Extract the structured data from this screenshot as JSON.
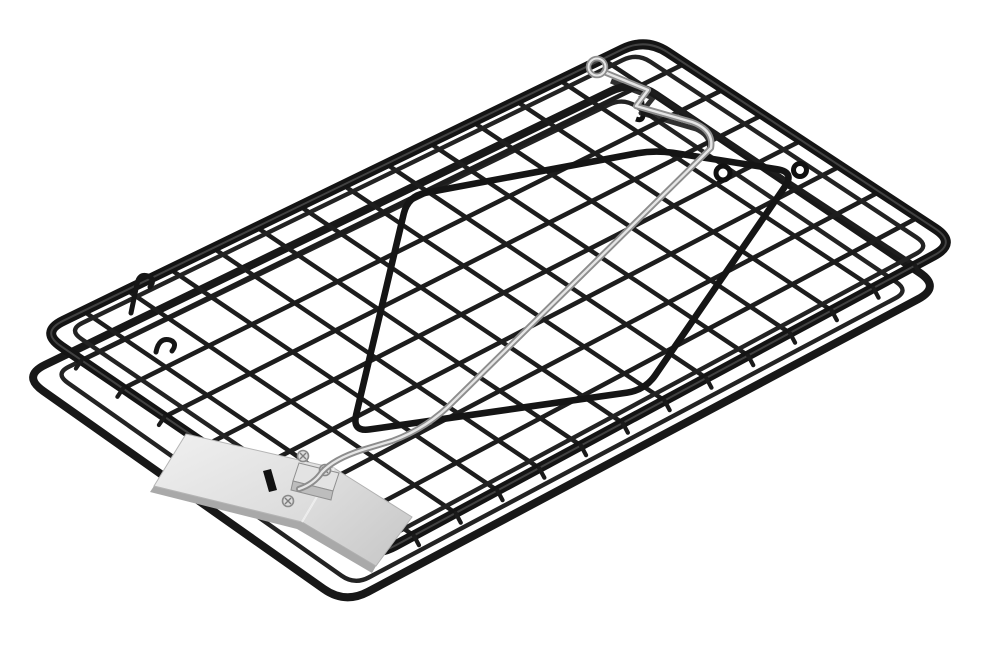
{
  "meta": {
    "alt": "Product photo of a flat black wire-mesh rodent tip trap shown at an angle on a plain white background, fitted with a stainless steel spring rod with an eyelet and zigzag crank, a black trigger bail wire, and a riveted stainless steel pedal plate with a latch bracket",
    "scene": "product-photo",
    "background": "#ffffff"
  },
  "palette": {
    "background": "#ffffff",
    "wire": "#1d1d1d",
    "wire_deep": "#141414",
    "wire_sheen": "#5a5a5a",
    "steel_dark": "#8d8d8d",
    "steel_light": "#e6e6e6",
    "plate_light": "#ebebeb",
    "plate_mid": "#d6d6d6",
    "plate_shadow": "#a9a9a9",
    "slot_black": "#111111"
  },
  "grid": {
    "columns": 14,
    "rows": 8
  },
  "object": {
    "name": "wire mesh tip trap",
    "parts": [
      {
        "id": "top-frame",
        "label": "black outer frame, top face, rounded corners"
      },
      {
        "id": "bottom-frame",
        "label": "black outer frame, bottom face, offset below"
      },
      {
        "id": "mesh-grid",
        "label": "welded black wire mesh, 14 by 8 square cells"
      },
      {
        "id": "inset-border",
        "label": "thin inset border wires on both faces"
      },
      {
        "id": "trigger-bail",
        "label": "black trigger bail loop with hinge knuckles"
      },
      {
        "id": "spring-rod",
        "label": "stainless spring rod: eyelet, zigzag crank, long diagonal arm, hook"
      },
      {
        "id": "pedal-plate",
        "label": "stainless pedal plate with three rivets, latch slot and bracket"
      },
      {
        "id": "hinge-stubs",
        "label": "small bent wire stubs on left side of mesh"
      },
      {
        "id": "wire-ticks",
        "label": "cut wire ends along lower edges"
      }
    ]
  }
}
